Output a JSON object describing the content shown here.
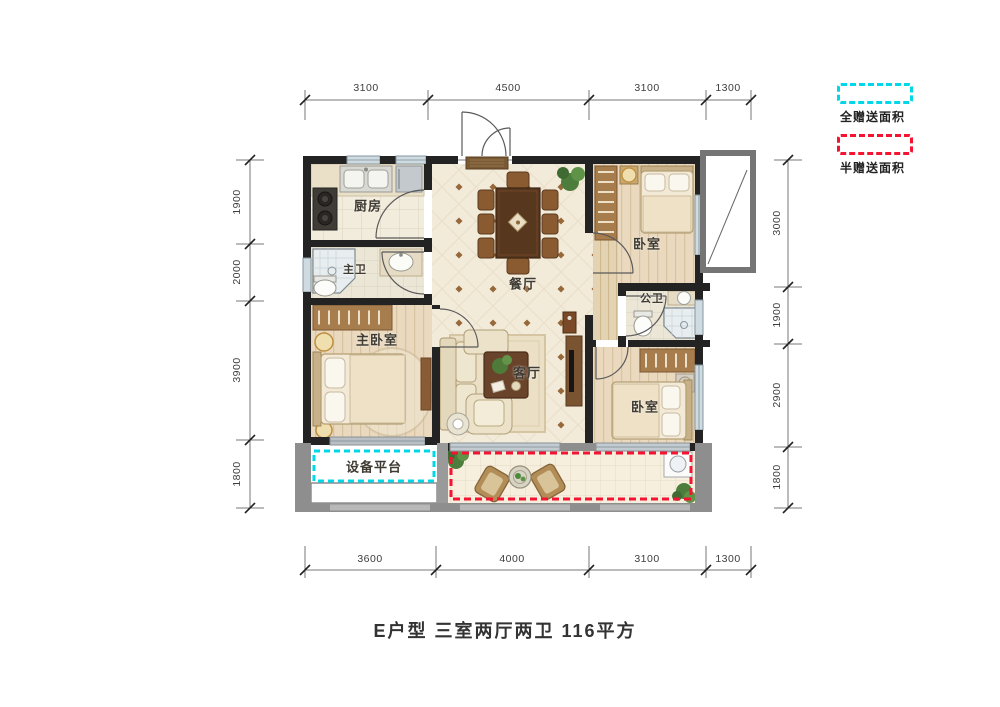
{
  "title": "E户型 三室两厅两卫  116平方",
  "legend": {
    "full_label": "全赠送面积",
    "half_label": "半赠送面积",
    "full_color": "#00d8ea",
    "half_color": "#f41331",
    "full_swatch_style": "border:3px dashed #00d8ea;border-radius:4px;background:#ffffff;",
    "half_swatch_style": "border:3px dashed #f41331;border-radius:4px;background:#ffffff;"
  },
  "rooms": {
    "kitchen": "厨房",
    "master_bath": "主卫",
    "master_bedroom": "主卧室",
    "dining": "餐厅",
    "living": "客厅",
    "bedroom_top": "卧室",
    "bedroom_bottom": "卧室",
    "public_bath": "公卫",
    "equipment_platform": "设备平台"
  },
  "dimensions": {
    "top": [
      "3100",
      "4500",
      "3100",
      "1300"
    ],
    "bottom": [
      "3600",
      "4000",
      "3100",
      "1300"
    ],
    "left": [
      "1900",
      "2000",
      "3900",
      "1800"
    ],
    "right": [
      "3000",
      "1900",
      "2900",
      "1800"
    ]
  }
}
